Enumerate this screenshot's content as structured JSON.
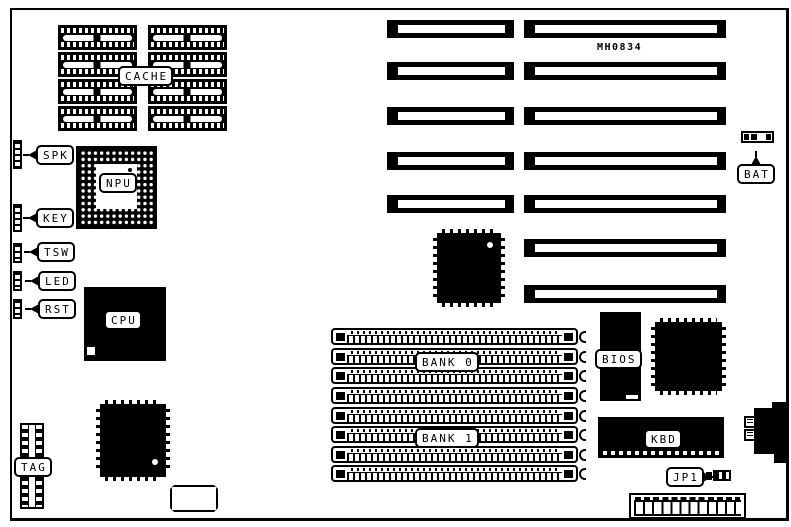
{
  "labels": {
    "part_number": "MH0834",
    "cache": "CACHE",
    "npu": "NPU",
    "cpu": "CPU",
    "spk": "SPK",
    "key": "KEY",
    "tsw": "TSW",
    "led": "LED",
    "rst": "RST",
    "tag": "TAG",
    "bank0": "BANK 0",
    "bank1": "BANK 1",
    "bios": "BIOS",
    "kbd": "KBD",
    "jp1": "JP1",
    "bat": "BAT"
  },
  "colors": {
    "ink": "#000000",
    "paper": "#ffffff"
  }
}
